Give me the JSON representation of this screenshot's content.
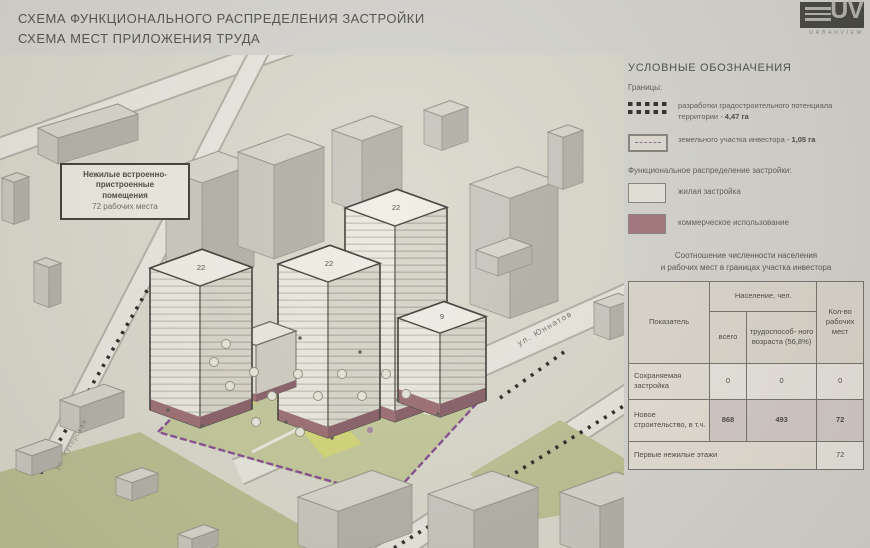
{
  "title": {
    "line1": "СХЕМА ФУНКЦИОНАЛЬНОГО РАСПРЕДЕЛЕНИЯ ЗАСТРОЙКИ",
    "line2": "СХЕМА МЕСТ ПРИЛОЖЕНИЯ ТРУДА"
  },
  "logo": {
    "monogram": "UV",
    "name": "URBANVIEW"
  },
  "map": {
    "callout": {
      "line1": "Нежилые встроенно-",
      "line2": "пристроенные",
      "line3": "помещения",
      "line4": "72 рабочих места"
    },
    "streets": {
      "right": "ул. Юннатов",
      "left": "ул. Хуторская"
    },
    "tower_labels": {
      "a": "22",
      "b": "22",
      "c": "22",
      "d": "9"
    }
  },
  "legend": {
    "header": "УСЛОВНЫЕ ОБОЗНАЧЕНИЯ",
    "group1": "Границы:",
    "items": [
      {
        "text": "разработки градостроительного потенциала территории - ",
        "value": "4,47 га"
      },
      {
        "text": "земельного участка инвестора - ",
        "value": "1,05 га"
      }
    ],
    "group2": "Функциональное распределение застройки:",
    "func_items": [
      {
        "label": "жилая застройка"
      },
      {
        "label": "коммерческое использование"
      }
    ]
  },
  "table": {
    "title_line1": "Соотношение численности населения",
    "title_line2": "и рабочих мест в границах участка инвестора",
    "headers": {
      "indicator": "Показатель",
      "population": "Население, чел.",
      "total": "всего",
      "working": "трудоспособ- ного возраста (56,8%)",
      "jobs": "Кол-во рабочих мест"
    },
    "rows": [
      {
        "label": "Сохраняемая застройка",
        "total": "0",
        "working": "0",
        "jobs": "0"
      },
      {
        "label": "Новое строительство, в т.ч.",
        "total": "868",
        "working": "493",
        "jobs": "72"
      },
      {
        "label": "Первые нежилые этажи",
        "jobs": "72"
      }
    ]
  },
  "colors": {
    "commercial": "#a3767c",
    "residential": "#e5e3da",
    "boundary_investor": "#7d3f8f",
    "boundary_potential": "#2b2a26",
    "lawn_green": "#c3c89a"
  }
}
